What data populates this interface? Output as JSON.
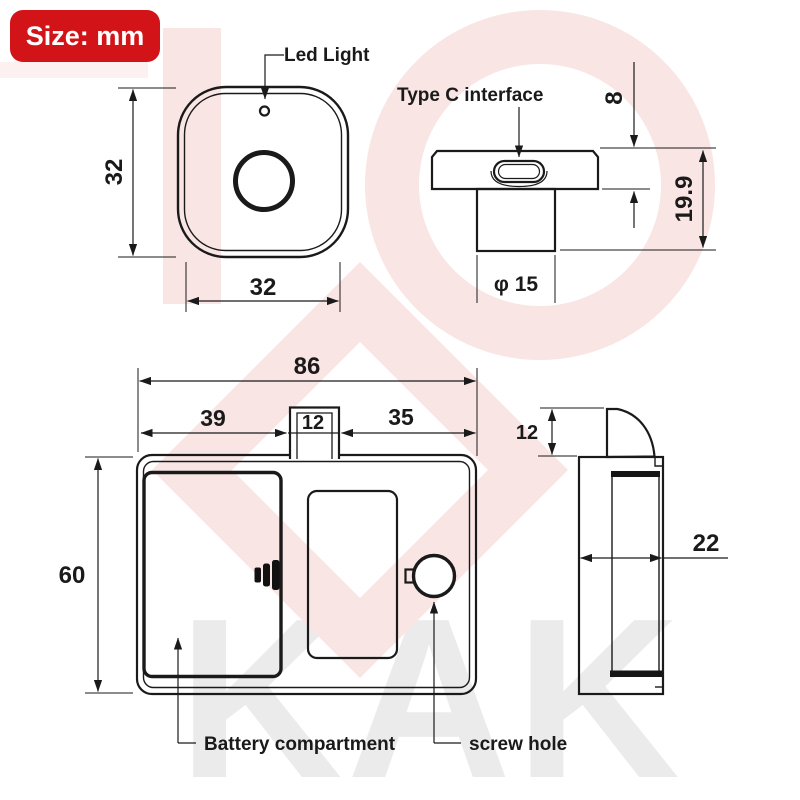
{
  "badge": {
    "text": "Size: mm",
    "bg_color": "#d21418",
    "text_color": "#ffffff"
  },
  "watermark": {
    "text": "KAK",
    "gray_color": "#ebebeb",
    "pink_color": "#f9e6e4"
  },
  "line_color": "#1a1a1a",
  "front_view": {
    "labels": {
      "led": "Led Light"
    },
    "dims": {
      "height": "32",
      "width": "32"
    }
  },
  "top_view": {
    "labels": {
      "type_c": "Type C interface"
    },
    "dims": {
      "cap_height": "8",
      "total_height": "19.9",
      "cylinder_diameter": "φ 15"
    }
  },
  "main_view": {
    "labels": {
      "battery": "Battery compartment",
      "screw": "screw hole"
    },
    "dims": {
      "width": "86",
      "left_section": "39",
      "tab_width": "12",
      "right_section": "35",
      "height": "60"
    }
  },
  "side_view": {
    "dims": {
      "latch_height": "12",
      "depth": "22"
    }
  }
}
